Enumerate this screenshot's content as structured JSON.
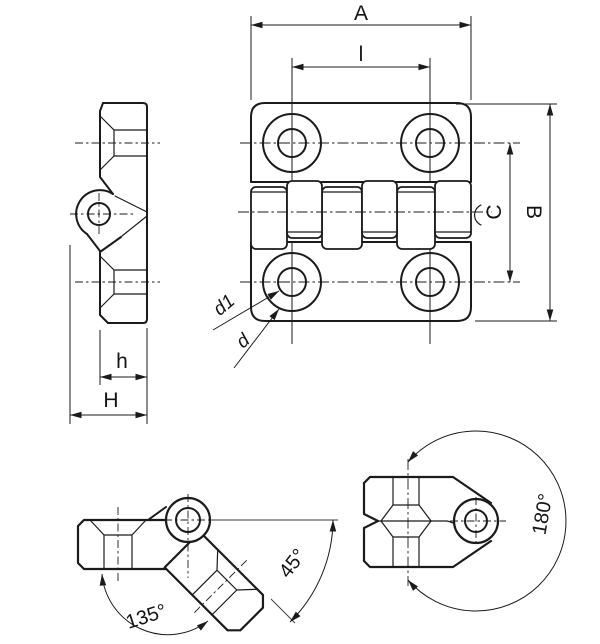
{
  "labels": {
    "front": {
      "width": "A",
      "hole_spacing": "l",
      "height": "B",
      "pitch_vertical": "C",
      "counterbore": "d1",
      "hole": "d"
    },
    "side": {
      "leaf_depth": "h",
      "overall_depth": "H"
    },
    "angles": {
      "open": "135°",
      "half": "45°",
      "fold": "180°"
    }
  },
  "colors": {
    "line": "#1b1b1b",
    "background": "#ffffff"
  }
}
